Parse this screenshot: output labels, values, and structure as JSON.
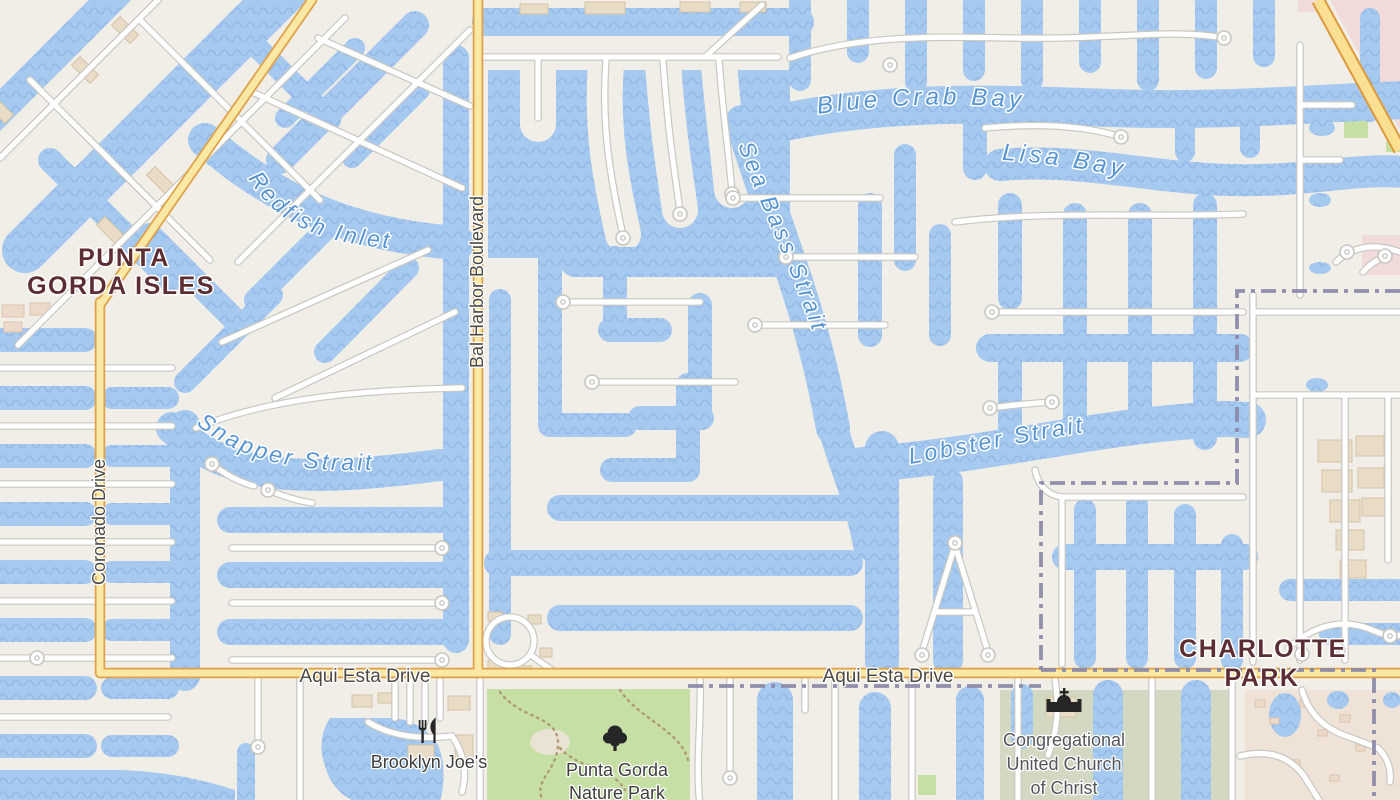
{
  "map": {
    "place_labels": {
      "punta_gorda_isles": {
        "line1": "PUNTA",
        "line2": "GORDA ISLES"
      },
      "charlotte_park": {
        "line1": "CHARLOTTE",
        "line2": "PARK"
      }
    },
    "water_labels": {
      "blue_crab_bay": "Blue Crab Bay",
      "lisa_bay": "Lisa Bay",
      "redfish_inlet": "Redfish Inlet",
      "sea_bass_strait": "Sea Bass Strait",
      "snapper_strait": "Snapper Strait",
      "lobster_strait": "Lobster Strait"
    },
    "road_labels": {
      "bal_harbor_boulevard": "Bal Harbor Boulevard",
      "coronado_drive": "Coronado Drive",
      "aqui_esta_drive_west": "Aqui Esta Drive",
      "aqui_esta_drive_east": "Aqui Esta Drive"
    },
    "poi_labels": {
      "restaurant": "Brooklyn Joe's",
      "nature_park": {
        "line1": "Punta Gorda",
        "line2": "Nature Park"
      },
      "church": {
        "line1": "Congregational",
        "line2": "United Church",
        "line3": "of Christ"
      }
    },
    "icons": {
      "restaurant": "fork-knife-icon",
      "nature_park": "tree-icon",
      "church": "church-icon"
    },
    "colors": {
      "land": "#f1eee8",
      "water": "#a6c9ef",
      "water_wave": "#8ab1e2",
      "road_primary_fill": "#fae8a4",
      "road_primary_casing": "#e0a148",
      "street_fill": "#ffffff",
      "street_casing": "#c9c7c2",
      "park_green": "#c6dfa5",
      "church_grounds_green": "#d2d8c2",
      "boundary_purple": "#8b89a9",
      "place_label_maroon": "#5c2e33",
      "water_label_blue": "#5795d2"
    }
  }
}
